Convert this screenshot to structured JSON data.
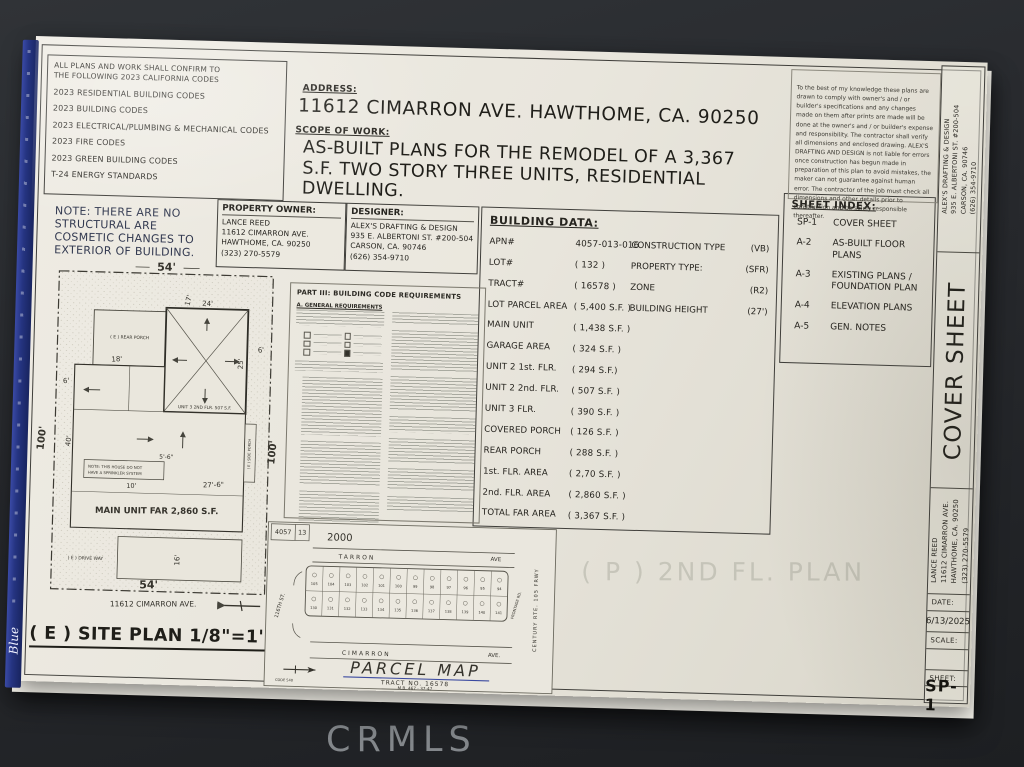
{
  "photo": {
    "watermark": "CRMLS"
  },
  "binding": {
    "logo": "Blue"
  },
  "codes_box": {
    "intro": "ALL PLANS AND WORK SHALL CONFIRM TO\nTHE FOLLOWING 2023 CALIFORNIA CODES",
    "items": [
      "2023 RESIDENTIAL BUILDING CODES",
      "2023 BUILDING CODES",
      "2023 ELECTRICAL/PLUMBING & MECHANICAL CODES",
      "2023 FIRE CODES",
      "2023 GREEN BUILDING CODES",
      "T-24 ENERGY STANDARDS"
    ]
  },
  "note": "NOTE: THERE ARE NO\nSTRUCTURAL ARE\nCOSMETIC CHANGES TO\nEXTERIOR OF BUILDING.",
  "address": {
    "label": "ADDRESS:",
    "value": "11612 CIMARRON AVE. HAWTHOME,  CA. 90250"
  },
  "scope": {
    "label": "SCOPE OF WORK:",
    "text": "AS-BUILT PLANS FOR THE  REMODEL OF A 3,367\nS.F. TWO STORY  THREE UNITS, RESIDENTIAL\nDWELLING."
  },
  "owner": {
    "label": "PROPERTY OWNER:",
    "lines": "LANCE REED\n11612 CIMARRON AVE.\nHAWTHOME, CA. 90250\n(323) 270-5579"
  },
  "designer": {
    "label": "DESIGNER:",
    "lines": "ALEX'S DRAFTING & DESIGN\n935 E. ALBERTONI ST. #200-504\nCARSON, CA. 90746\n(626) 354-9710"
  },
  "building_data": {
    "title": "BUILDING DATA:",
    "rows_left": [
      {
        "label": "APN#",
        "value": "4057-013-016"
      },
      {
        "label": "LOT#",
        "value": "( 132 )"
      },
      {
        "label": "TRACT#",
        "value": "( 16578 )"
      },
      {
        "label": "LOT PARCEL AREA",
        "value": "( 5,400 S.F. )"
      },
      {
        "label": "MAIN UNIT",
        "value": "( 1,438 S.F. )"
      },
      {
        "label": "GARAGE AREA",
        "value": "( 324 S.F. )"
      },
      {
        "label": "UNIT 2 1st. FLR.",
        "value": "( 294 S.F.)"
      },
      {
        "label": "UNIT 2 2nd. FLR.",
        "value": "( 507 S.F. )"
      },
      {
        "label": "UNIT 3 FLR.",
        "value": "( 390 S.F. )"
      },
      {
        "label": "COVERED PORCH",
        "value": "( 126 S.F. )"
      },
      {
        "label": "REAR PORCH",
        "value": "( 288 S.F. )"
      },
      {
        "label": "1st. FLR. AREA",
        "value": "( 2,70 S.F. )"
      },
      {
        "label": "2nd. FLR. AREA",
        "value": "( 2,860 S.F. )"
      },
      {
        "label": "TOTAL FAR AREA",
        "value": "( 3,367 S.F. )"
      }
    ],
    "rows_right": [
      {
        "label": "CONSTRUCTION TYPE",
        "value": "(VB)"
      },
      {
        "label": "PROPERTY TYPE:",
        "value": "(SFR)"
      },
      {
        "label": "ZONE",
        "value": "(R2)"
      },
      {
        "label": "BUILDING HEIGHT",
        "value": "(27')"
      }
    ]
  },
  "sheet_index": {
    "title": "SHEET INDEX:",
    "items": [
      {
        "code": "SP-1",
        "label": "COVER SHEET"
      },
      {
        "code": "A-2",
        "label": "AS-BUILT FLOOR PLANS"
      },
      {
        "code": "A-3",
        "label": "EXISTING PLANS / FOUNDATION PLAN"
      },
      {
        "code": "A-4",
        "label": "ELEVATION PLANS"
      },
      {
        "code": "A-5",
        "label": "GEN. NOTES"
      }
    ]
  },
  "disclaimer": "To the best of my knowledge these plans are drawn to comply with owner's and / or builder's specifications and any changes made on them after prints are made will be done at the owner's and / or builder's expense and responsibility. The contractor shall verify all dimensions and enclosed drawing. ALEX'S DRAFTING AND DESIGN is not liable for errors once construction has begun made in preparation of this plan to avoid mistakes, the maker can not guarantee against human error. The contractor of the job must check all dimensions and other details prior to construction and be solely responsible thereafter.",
  "code_requirements": {
    "title": "PART III:  BUILDING CODE REQUIREMENTS",
    "section": "A.  GENERAL REQUIREMENTS"
  },
  "site_plan": {
    "title": "( E ) SITE PLAN 1/8\"=1'-0\"",
    "street": "11612 CIMARRON AVE.",
    "unit3": "UNIT 3 2ND FLR. 507 S.F.",
    "main_unit": "MAIN UNIT FAR 2,860 S.F.",
    "rear_porch": "( E ) REAR PORCH",
    "side_porch": "( E ) SIDE PORCH",
    "driveway": "( E ) DRIVE WAY",
    "sprinkler_note_1": "NOTE: THIS HOUSE DO NOT",
    "sprinkler_note_2": "HAVE A SPRINKLER SYSTEM",
    "dims": {
      "top": "54'",
      "bottom": "54'",
      "left": "100'",
      "right": "100'",
      "d17": "17'",
      "d24": "24'",
      "d18": "18'",
      "d25": "25'",
      "d40": "40'",
      "d6a": "6'",
      "d6b": "6'",
      "d16": "16'",
      "d10": "10'",
      "d5_6": "5'-6\"",
      "d27_6": "27'-6\""
    }
  },
  "parcel_map": {
    "title": "PARCEL MAP",
    "tract": "TRACT NO. 16578",
    "mb": "M.B. 467 - 37-47",
    "street_top": "TARRON",
    "street_top_suffix": "AVE",
    "street_bottom": "CIMARRON",
    "street_bottom_suffix": "AVE.",
    "street_left": "116TH ST.",
    "hwy": "CENTURY      RTE. 105      FRWY",
    "frontage": "FRONTAGE RD.",
    "corner_a": "4057",
    "corner_b": "13",
    "scale_text": "2000",
    "code_text": "CODE 540",
    "lots_top": [
      "105",
      "104",
      "103",
      "102",
      "101",
      "100",
      "99",
      "98",
      "97",
      "96",
      "95",
      "94"
    ],
    "lots_bottom": [
      "130",
      "131",
      "132",
      "133",
      "134",
      "135",
      "136",
      "137",
      "138",
      "139",
      "140",
      "141"
    ]
  },
  "title_block": {
    "designer_block": "ALEX'S DRAFTING & DESIGN\n935 E. ALBERTONI ST. #200-504\nCARSON, CA. 90746\n(626) 354-9710",
    "sheet_title": "COVER SHEET",
    "owner_block": "LANCE REED\n11612 CIMARRON AVE.\nHAWTHOME, CA. 90250\n(323) 270-5579",
    "date_label": "DATE:",
    "date_value": "6/13/2025",
    "scale_label": "SCALE:",
    "scale_value": "",
    "sheet_label": "SHEET:",
    "sheet_value": "SP-1"
  },
  "bleed_through": "( P ) 2ND FL. PLAN"
}
